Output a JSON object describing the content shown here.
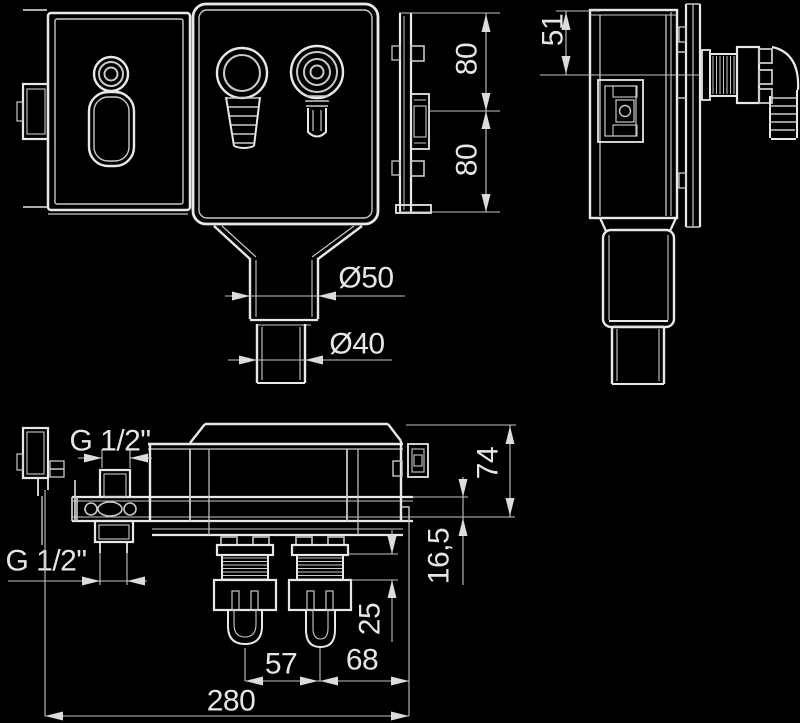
{
  "colors": {
    "background": "#000000",
    "line": "#e8e8e8",
    "dimension_line": "#c4c4c4",
    "text": "#e6e6e6"
  },
  "labels": {
    "dim_80_upper": "80",
    "dim_80_lower": "80",
    "dim_51": "51",
    "dia_50": "Ø50",
    "dia_40": "Ø40",
    "thread_g_half_top": "G 1/2\"",
    "thread_g_half_bottom": "G 1/2\"",
    "dim_74": "74",
    "dim_16_5": "16,5",
    "dim_25": "25",
    "dim_57": "57",
    "dim_68": "68",
    "dim_280": "280"
  }
}
